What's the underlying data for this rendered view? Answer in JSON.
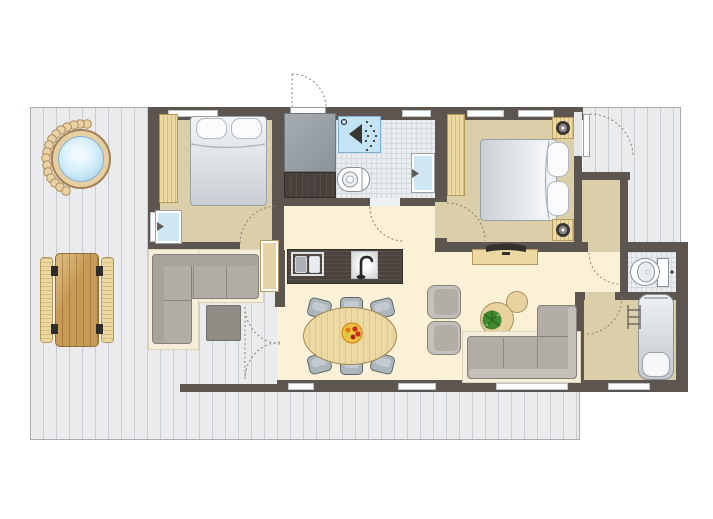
{
  "title": "holiday-lodge-floor-plan",
  "colors": {
    "wall": "#5d554f",
    "floor-cream": "#faf1d7",
    "floor-beige": "#dbcfa9",
    "tile": "#e9edf0",
    "tile-grid": "#d3dae0",
    "deck": "#e9ebed",
    "deck-stripe": "#c9ccd0",
    "deck-border": "#aaaeb3",
    "wood-light": "#ecd9a2",
    "wood-grain": "#b59a5e",
    "picnic-wood": "#c79a55",
    "counter-dark": "#4b433e",
    "sofa": "#b2ada6",
    "sofa-light": "#c5c0b9",
    "sofa-edge": "#85807a",
    "rug": "#f4eeda",
    "chair": "#aeb6bd",
    "chair-edge": "#5d646b",
    "mattress-hi": "#f2f4f6",
    "mattress-lo": "#c9cfd5",
    "shower": "#c3e4f5",
    "shower-edge": "#7fb2d2",
    "basin-blue": "#cfe7f4",
    "appliance": "#9aa1a6",
    "plant": "#3f8a2e",
    "table-wood": "#ecd9a4",
    "dotted": "#8a8276",
    "window": "#fdfdfd",
    "fixture-edge": "#8a9196",
    "water-hi": "#f0fafe",
    "water-lo": "#9ccbe8",
    "hot-tub-ring": "#e6cfa0",
    "fruit-bowl": "#f0c043",
    "berry": "#cc2b22"
  },
  "rooms": [
    "deck",
    "terrace",
    "bedroom-1",
    "entrance",
    "bathroom",
    "bedroom-2",
    "hallway",
    "kitchen",
    "dining-area",
    "lounge",
    "vestibule",
    "wc",
    "bathroom-2",
    "back-porch"
  ],
  "furniture": [
    "hot-tub",
    "picnic-table",
    "picnic-bench",
    "outdoor-corner-sofa",
    "ottoman",
    "side-table",
    "double-bed",
    "pillows",
    "wardrobe",
    "washbasin",
    "fridge-cabinet",
    "dresser",
    "shower",
    "toilet",
    "kitchen-counter",
    "kitchen-sink",
    "kitchen-tap",
    "dining-table",
    "dining-chair",
    "fruit-bowl",
    "tv-cabinet",
    "tv",
    "armchair",
    "coffee-table",
    "potted-plant",
    "corner-sofa",
    "nightstand",
    "lamp",
    "bathtub",
    "towel-rail"
  ],
  "doors": [
    "front-door",
    "bedroom-1-door",
    "bathroom-door",
    "bedroom-2-door",
    "terrace-french-doors",
    "deck-door-bedroom-2",
    "porch-door",
    "bathroom-2-door"
  ],
  "windows_count": 9
}
